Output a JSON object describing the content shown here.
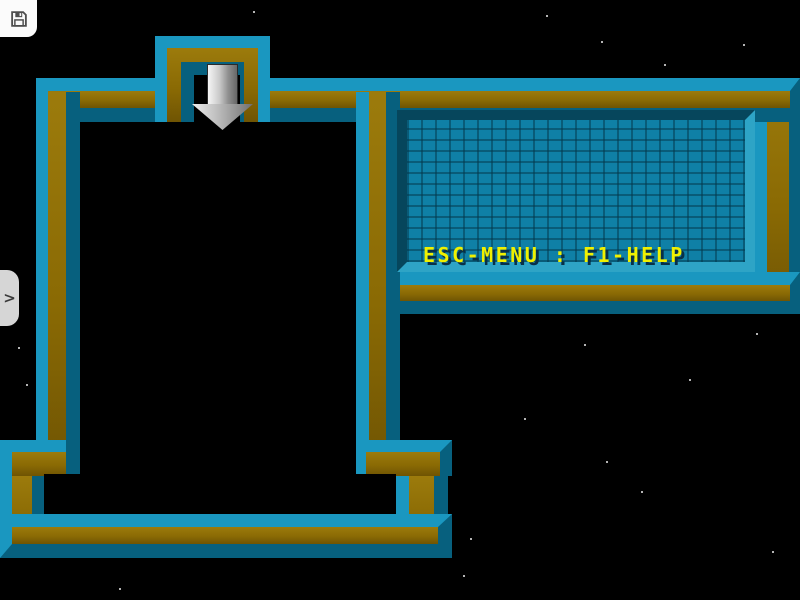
{
  "panel": {
    "rows": [
      {
        "id": "player",
        "label": "Player:",
        "value": "123",
        "indent": 12
      },
      {
        "id": "level",
        "label": "Level:",
        "value": "1 - Simple",
        "indent": 0
      },
      {
        "id": "score",
        "label": "Score:",
        "value": "0",
        "indent": 0
      },
      {
        "id": "mult",
        "label": "Mult:",
        "value": "1",
        "suffix": "X",
        "indent": 0
      }
    ],
    "help_text": "ESC-MENU : F1-HELP",
    "colors": {
      "label": "#12d2e6",
      "value": "#f6f6f6",
      "suffix": "#12d2e6",
      "help": "#f0f000",
      "shadow": "#083048"
    }
  },
  "game": {
    "spawn_arrow": "down-arrow",
    "guide_lines": [
      {
        "y": 156,
        "color": "#c08508"
      },
      {
        "y": 280,
        "color": "#bababa"
      },
      {
        "y": 398,
        "color": "#bf6a52"
      }
    ],
    "pieces": [
      {
        "type": "tile",
        "name": "block-tile",
        "x": 78,
        "y": 438,
        "w": 40,
        "h": 40
      },
      {
        "type": "tile",
        "name": "block-tile",
        "x": 40,
        "y": 478,
        "w": 38,
        "h": 37
      },
      {
        "type": "tile",
        "name": "block-tile",
        "x": 318,
        "y": 478,
        "w": 40,
        "h": 37
      },
      {
        "type": "tile",
        "name": "block-tile",
        "x": 358,
        "y": 478,
        "w": 40,
        "h": 37
      },
      {
        "type": "rect",
        "name": "pipe-tee-bar",
        "x": 78,
        "y": 446,
        "w": 38,
        "h": 24
      },
      {
        "type": "rect",
        "name": "pipe-tee-stub",
        "x": 88,
        "y": 436,
        "w": 17,
        "h": 13
      },
      {
        "type": "rect",
        "name": "arrow-left-head",
        "x": 44,
        "y": 482,
        "w": 27,
        "h": 30
      },
      {
        "type": "rect",
        "name": "arrow-left-stem",
        "x": 70,
        "y": 493,
        "w": 11,
        "h": 10
      },
      {
        "type": "rect",
        "name": "arrow-right-stem",
        "x": 325,
        "y": 490,
        "w": 37,
        "h": 12
      },
      {
        "type": "tri",
        "name": "arrow-right-head",
        "x": 358,
        "y": 479,
        "w": 37,
        "h": 36
      }
    ],
    "stars": [
      [
        253,
        11
      ],
      [
        546,
        15
      ],
      [
        601,
        41
      ],
      [
        664,
        64
      ],
      [
        743,
        44
      ],
      [
        131,
        168
      ],
      [
        116,
        186
      ],
      [
        303,
        137
      ],
      [
        98,
        290
      ],
      [
        214,
        272
      ],
      [
        166,
        376
      ],
      [
        260,
        357
      ],
      [
        310,
        446
      ],
      [
        282,
        333
      ],
      [
        334,
        291
      ],
      [
        584,
        344
      ],
      [
        689,
        379
      ],
      [
        641,
        491
      ],
      [
        606,
        461
      ],
      [
        524,
        418
      ],
      [
        463,
        575
      ],
      [
        772,
        551
      ],
      [
        470,
        538
      ],
      [
        756,
        333
      ],
      [
        119,
        588
      ],
      [
        18,
        347
      ],
      [
        26,
        384
      ]
    ],
    "rivets": [
      [
        56,
        93
      ],
      [
        98,
        93
      ],
      [
        296,
        93
      ],
      [
        336,
        93
      ],
      [
        376,
        93
      ],
      [
        416,
        93
      ],
      [
        456,
        93
      ],
      [
        496,
        93
      ],
      [
        536,
        93
      ],
      [
        576,
        93
      ],
      [
        616,
        93
      ],
      [
        656,
        93
      ],
      [
        696,
        93
      ],
      [
        736,
        93
      ],
      [
        776,
        93
      ],
      [
        177,
        51
      ],
      [
        215,
        51
      ],
      [
        252,
        51
      ],
      [
        50,
        136
      ],
      [
        50,
        178
      ],
      [
        50,
        220
      ],
      [
        50,
        262
      ],
      [
        50,
        304
      ],
      [
        50,
        346
      ],
      [
        50,
        388
      ],
      [
        50,
        430
      ],
      [
        15,
        455
      ],
      [
        52,
        455
      ],
      [
        54,
        531
      ],
      [
        96,
        531
      ],
      [
        138,
        531
      ],
      [
        180,
        531
      ],
      [
        222,
        531
      ],
      [
        264,
        531
      ],
      [
        306,
        531
      ],
      [
        348,
        531
      ],
      [
        390,
        531
      ],
      [
        432,
        531
      ],
      [
        417,
        458
      ],
      [
        417,
        496
      ],
      [
        373,
        136
      ],
      [
        373,
        178
      ],
      [
        373,
        220
      ],
      [
        373,
        262
      ],
      [
        373,
        304
      ],
      [
        373,
        346
      ],
      [
        373,
        388
      ],
      [
        373,
        430
      ],
      [
        777,
        138
      ],
      [
        777,
        178
      ],
      [
        777,
        218
      ],
      [
        777,
        258
      ],
      [
        420,
        289
      ],
      [
        460,
        289
      ],
      [
        500,
        289
      ],
      [
        540,
        289
      ],
      [
        580,
        289
      ],
      [
        620,
        289
      ],
      [
        660,
        289
      ],
      [
        700,
        289
      ],
      [
        740,
        289
      ]
    ]
  },
  "ui": {
    "save_icon": "floppy-disk-icon",
    "drawer_chevron": ">"
  },
  "colors": {
    "wall_teal_bright": "#1a97c0",
    "wall_teal_dark": "#07607e",
    "wall_gold": "#8a6a04",
    "panel_brick": "#0f80a6",
    "piece_gold": "#d3a015",
    "background": "#000000"
  }
}
